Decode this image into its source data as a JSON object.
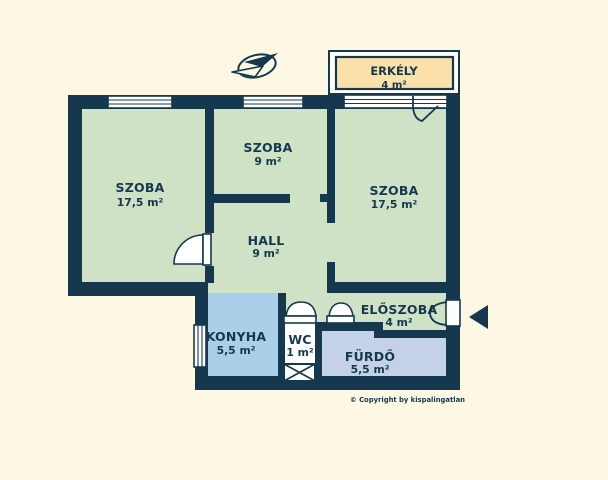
{
  "title": "Apartment floor plan",
  "rooms": {
    "szoba_left": {
      "label": "SZOBA",
      "area": "17,5 m²"
    },
    "szoba_middle": {
      "label": "SZOBA",
      "area": "9 m²"
    },
    "szoba_right": {
      "label": "SZOBA",
      "area": "17,5 m²"
    },
    "hall": {
      "label": "HALL",
      "area": "9 m²"
    },
    "erkely": {
      "label": "ERKÉLY",
      "area": "4 m²"
    },
    "eloszoba": {
      "label": "ELŐSZOBA",
      "area": "4 m²"
    },
    "konyha": {
      "label": "KONYHA",
      "area": "5,5 m²"
    },
    "wc": {
      "label": "WC",
      "area": "1 m²"
    },
    "furdo": {
      "label": "FÜRDŐ",
      "area": "5,5 m²"
    }
  },
  "footer": {
    "copyright": "© Copyright by kispalingatlan"
  },
  "icons": {
    "compass": "north-compass-arrow",
    "entry_arrow": "entrance-direction-arrow",
    "shaft": "ventilation-shaft-crossed-box"
  },
  "colors": {
    "bg": "#fcf8e3",
    "wall": "#16384e",
    "ink": "#16384e",
    "room-green": "#cfe2c6",
    "kitchen-blue": "#a9cfe9",
    "bath-blue": "#c3d2e6",
    "wc-white": "#ffffff",
    "balcony-tan": "#fbe1a9",
    "balcony-margin": "#fffef7"
  }
}
